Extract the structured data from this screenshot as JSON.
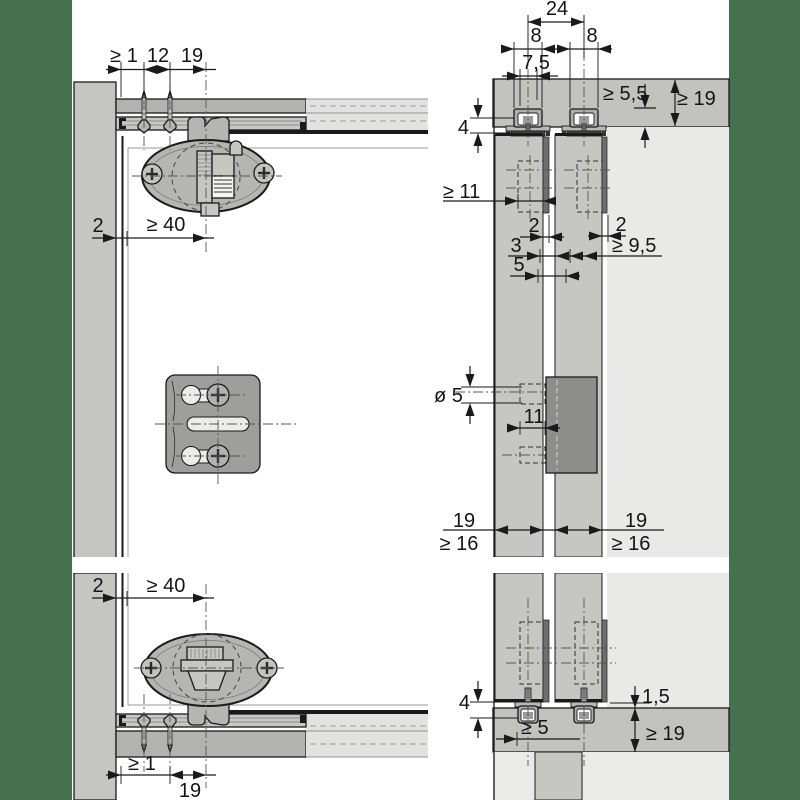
{
  "title": "Sliding door fitting installation drawing",
  "colors": {
    "background": "#47714e",
    "paper": "#ffffff",
    "wall_panel": "#c5c5c1",
    "board_band": "#b2b2ae",
    "break_band": "#e2e2e0",
    "rail_profile": "#c8c8c4",
    "interior": "#e9e9e7",
    "door_section": "#c6c6c2",
    "edge_strip": "#6f6f6d",
    "soft_close_unit": "#8d8d8b",
    "fitting_oval": "#b5b5b1",
    "plate": "#9e9e9c",
    "line": "#1a1a1a"
  },
  "views": {
    "top_left": {
      "name": "top corner front view",
      "dims": {
        "min1": "≥ 1",
        "d12": "12",
        "d19": "19",
        "d2": "2",
        "min40": "≥ 40"
      }
    },
    "top_right": {
      "name": "top rail cross-section",
      "dims": {
        "d24": "24",
        "d8_left": "8",
        "d8_right": "8",
        "d7_5": "7,5",
        "min5_5": "≥ 5,5",
        "min19": "≥ 19",
        "d4": "4",
        "min11": "≥ 11",
        "d2_left": "2",
        "d3": "3",
        "d5": "5",
        "d2_right": "2",
        "min9_5": "≥ 9,5",
        "dia5": "ø 5",
        "d11": "11",
        "d19_left": "19",
        "min16_left": "≥ 16",
        "d19_right": "19",
        "min16_right": "≥ 16"
      }
    },
    "bottom_left": {
      "name": "bottom corner front view",
      "dims": {
        "d2": "2",
        "min40": "≥ 40",
        "min1": "≥ 1",
        "d19": "19"
      }
    },
    "bottom_right": {
      "name": "bottom guide cross-section",
      "dims": {
        "d4": "4",
        "d1_5": "1,5",
        "min5": "≥ 5",
        "min19": "≥ 19"
      }
    }
  }
}
